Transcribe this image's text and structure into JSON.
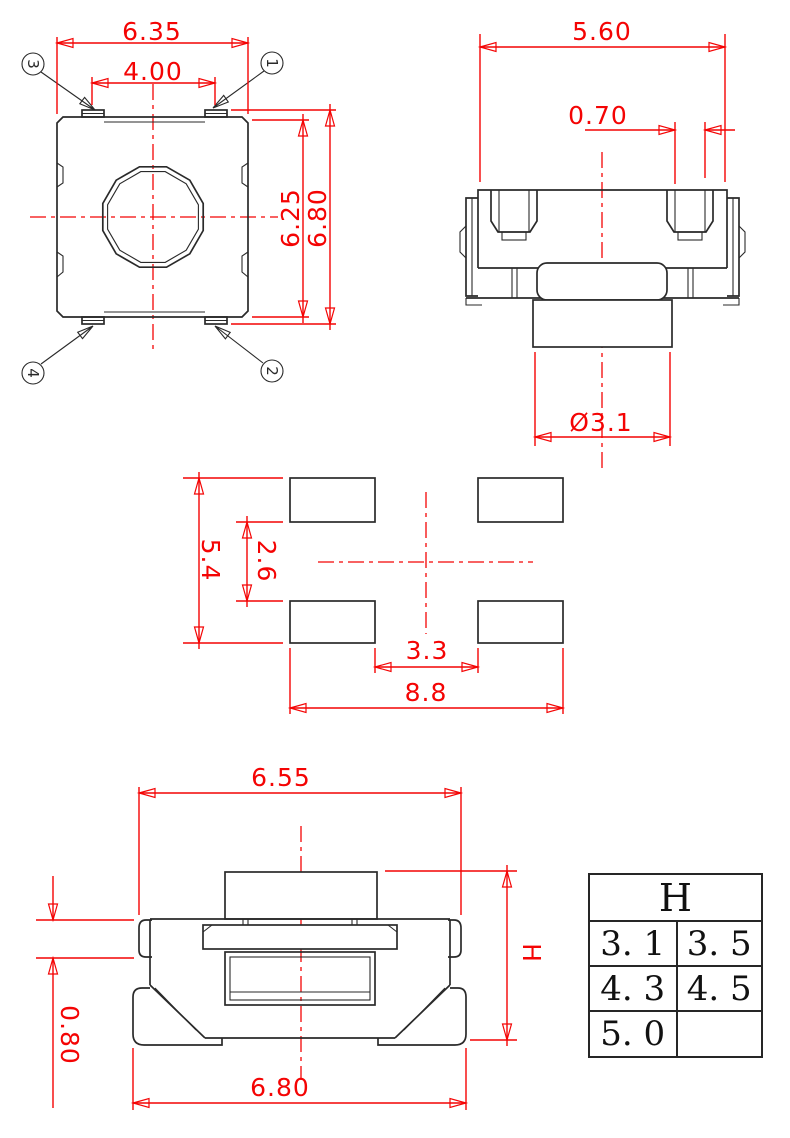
{
  "colors": {
    "dimension_red": "#f40404",
    "line_black": "#2a2a2a",
    "background": "#ffffff"
  },
  "views": {
    "top": {
      "dims": {
        "outer_width": "6.35",
        "terminal_pitch": "4.00",
        "body_height": "6.25",
        "overall_height": "6.80"
      },
      "balloons": {
        "b1": "1",
        "b2": "2",
        "b3": "3",
        "b4": "4"
      }
    },
    "side": {
      "dims": {
        "body_width": "5.60",
        "lug_width": "0.70",
        "stem_diameter": "Ø3.1"
      }
    },
    "land": {
      "dims": {
        "pad_outer_vertical": "5.4",
        "pad_inner_vertical": "2.6",
        "pad_inner_horizontal": "3.3",
        "pad_outer_horizontal": "8.8"
      }
    },
    "front": {
      "dims": {
        "top_width": "6.55",
        "bracket_height": "0.80",
        "bottom_width": "6.80",
        "height_label": "H"
      }
    },
    "table": {
      "header": "H",
      "rows": [
        [
          "3. 1",
          "3. 5"
        ],
        [
          "4. 3",
          "4. 5"
        ],
        [
          "5. 0",
          ""
        ]
      ]
    }
  }
}
